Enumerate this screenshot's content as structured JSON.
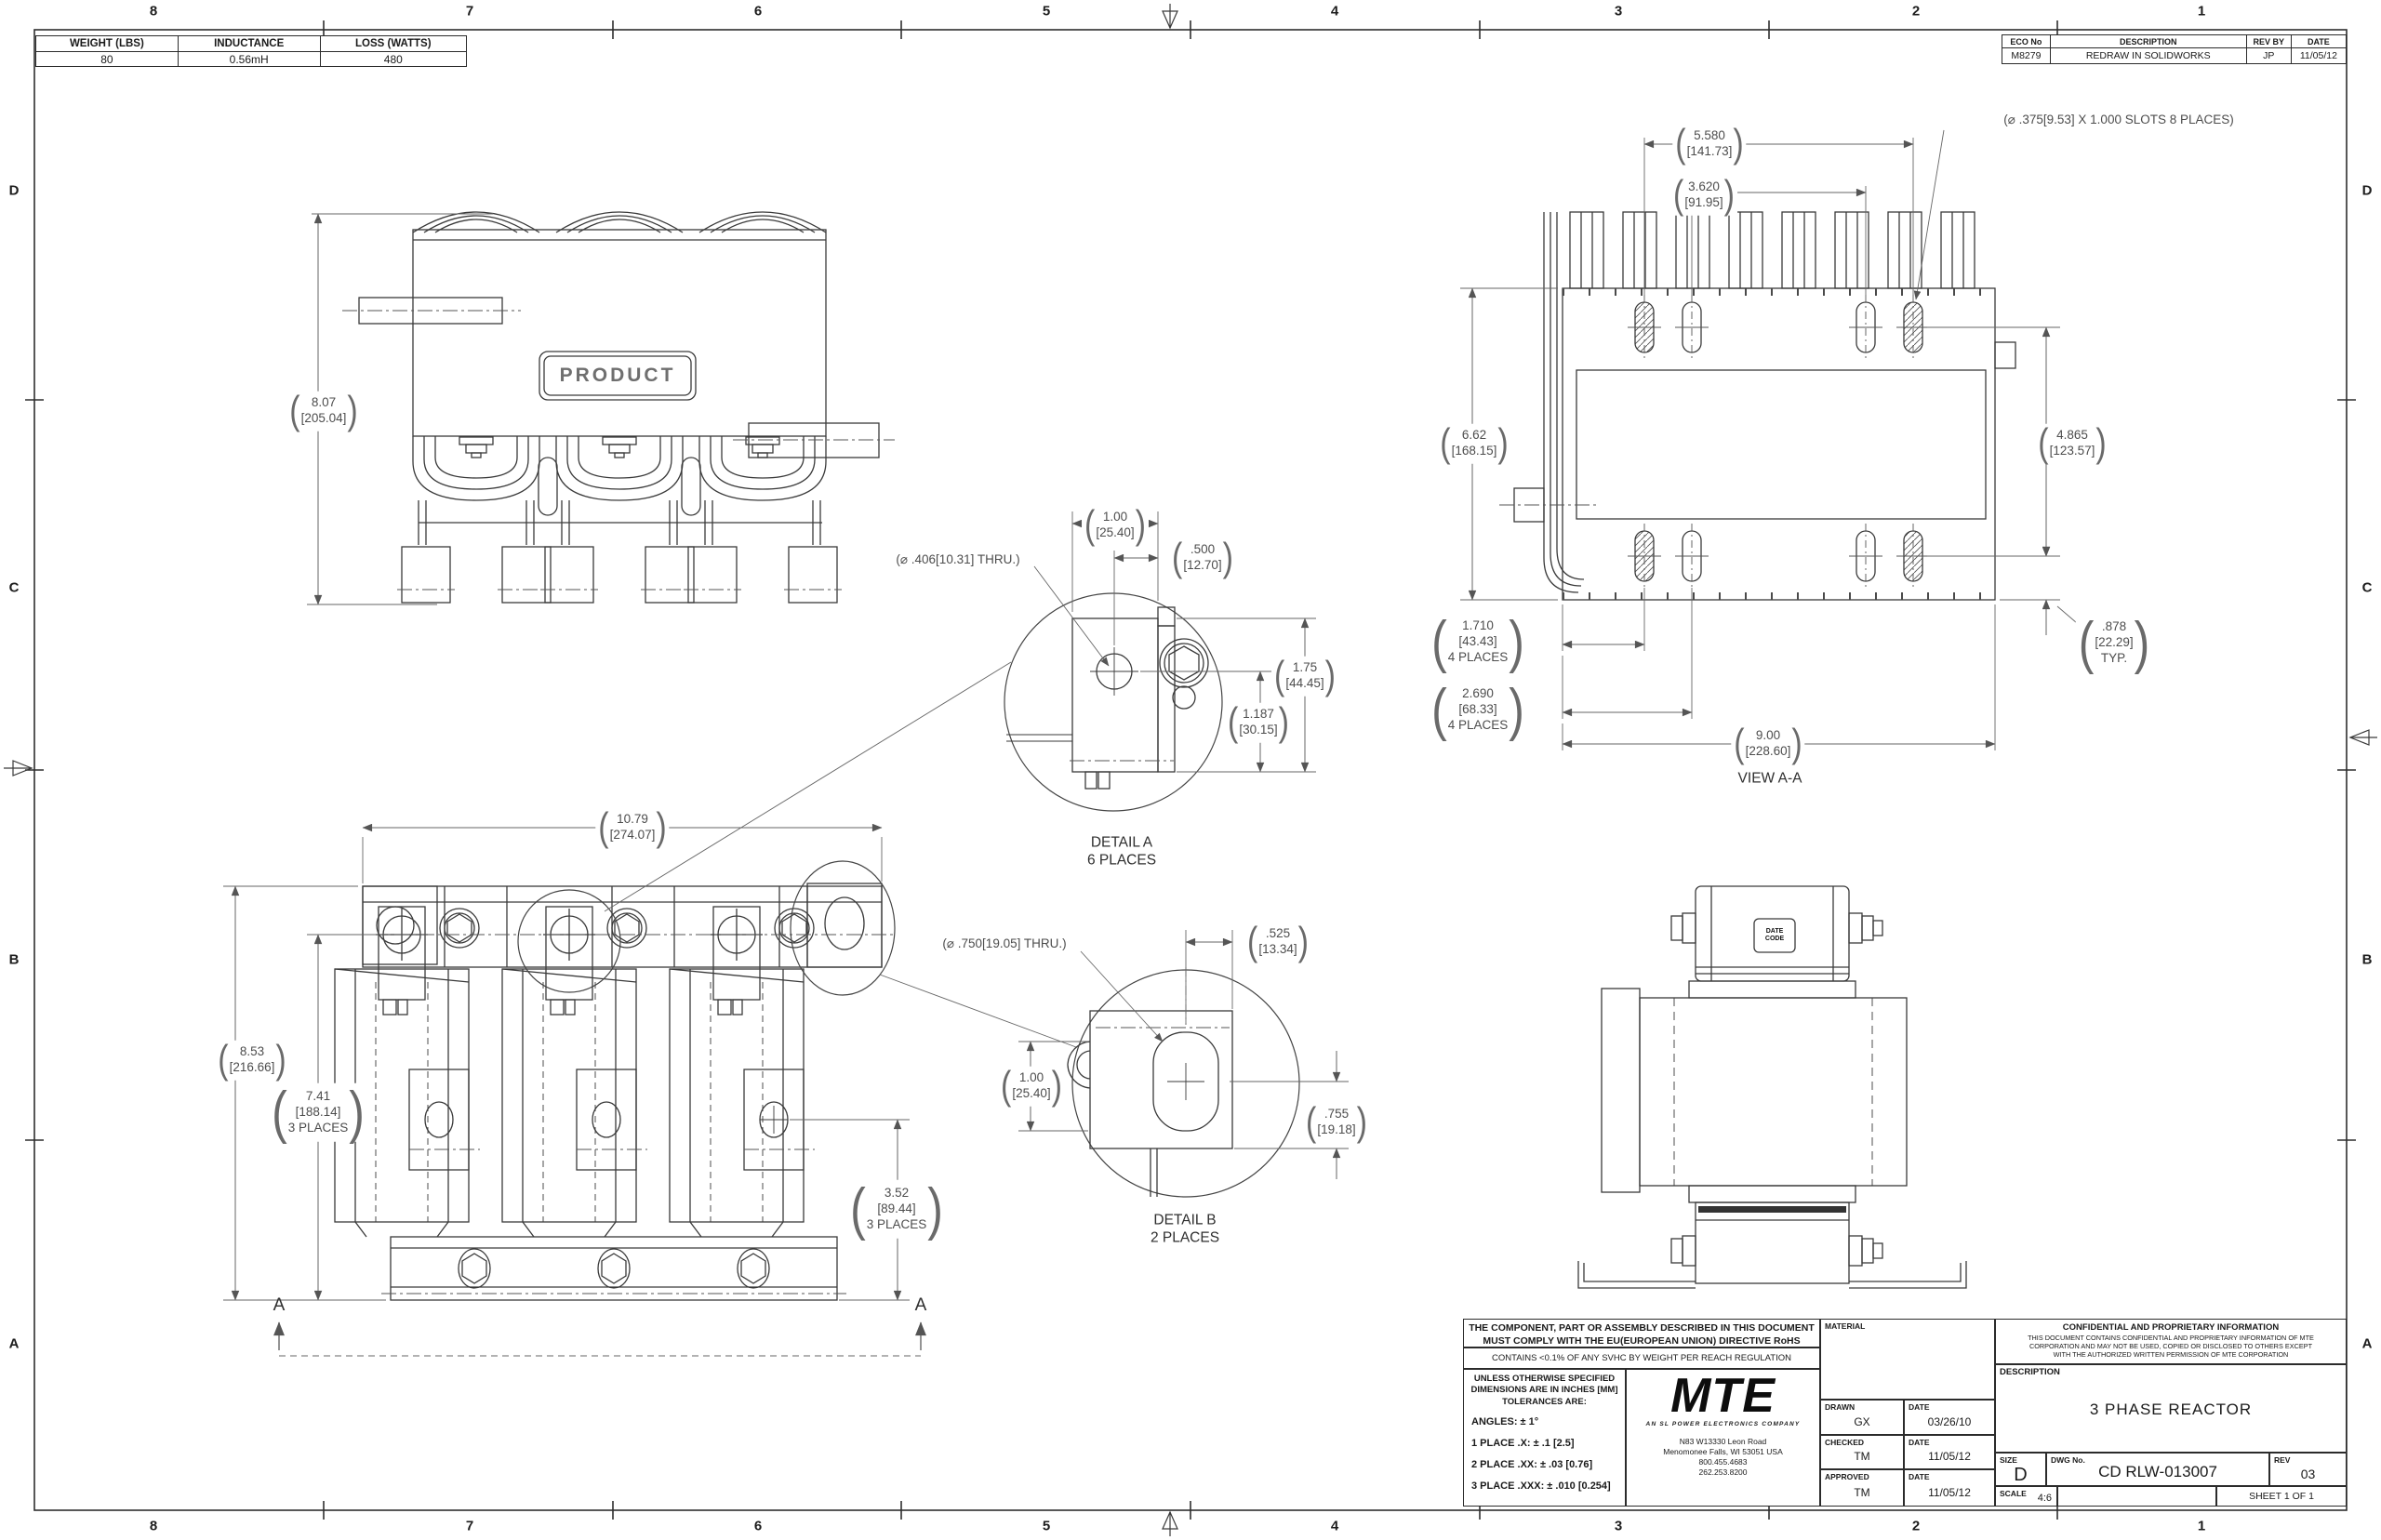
{
  "colors": {
    "part_line": "#3a3a3a",
    "dim_line": "#666666",
    "text": "#1a1a1a"
  },
  "sym": {
    "lp": "(",
    "rp": ")"
  },
  "zones": {
    "cols": [
      "8",
      "7",
      "6",
      "5",
      "4",
      "3",
      "2",
      "1"
    ],
    "rows": [
      "D",
      "C",
      "B",
      "A"
    ]
  },
  "spec_table": {
    "headers": [
      "WEIGHT (LBS)",
      "INDUCTANCE",
      "LOSS (WATTS)"
    ],
    "values": [
      "80",
      "0.56mH",
      "480"
    ]
  },
  "eco_table": {
    "headers": [
      "ECO No",
      "DESCRIPTION",
      "REV BY",
      "DATE"
    ],
    "values": [
      "M8279",
      "REDRAW IN SOLIDWORKS",
      "JP",
      "11/05/12"
    ]
  },
  "front_top": {
    "product": "PRODUCT",
    "dim_height": "8.07\n[205.04]"
  },
  "view_aa": {
    "label": "VIEW A-A",
    "dim_w1": "5.580\n[141.73]",
    "dim_w2": "3.620\n[91.95]",
    "note_slots": "(⌀ .375[9.53] X 1.000 SLOTS 8 PLACES)",
    "dim_h": "6.62\n[168.15]",
    "dim_right": "4.865\n[123.57]",
    "dim_typ": ".878\n[22.29]\nTYP.",
    "dim_d1": "1.710\n[43.43]\n4 PLACES",
    "dim_d2": "2.690\n[68.33]\n4 PLACES",
    "dim_w": "9.00\n[228.60]"
  },
  "detail_a": {
    "title": "DETAIL A\n6 PLACES",
    "note_hole": "(⌀ .406[10.31] THRU.)",
    "dim_1": "1.00\n[25.40]",
    "dim_2": ".500\n[12.70]",
    "dim_3": "1.75\n[44.45]",
    "dim_4": "1.187\n[30.15]"
  },
  "detail_b": {
    "title": "DETAIL B\n2 PLACES",
    "note_hole": "(⌀ .750[19.05] THRU.)",
    "dim_1": ".525\n[13.34]",
    "dim_2": "1.00\n[25.40]",
    "dim_3": ".755\n[19.18]"
  },
  "front_bottom": {
    "dim_w": "10.79\n[274.07]",
    "dim_h1": "8.53\n[216.66]",
    "dim_h2": "7.41\n[188.14]\n3 PLACES",
    "dim_h3": "3.52\n[89.44]\n3 PLACES",
    "section_letter": "A"
  },
  "side_view": {
    "date_code": "DATE\nCODE"
  },
  "title_block": {
    "rohs": "THE COMPONENT, PART OR ASSEMBLY DESCRIBED IN THIS DOCUMENT\nMUST COMPLY WITH THE EU(EUROPEAN UNION) DIRECTIVE RoHS",
    "reach": "CONTAINS <0.1% OF ANY SVHC BY WEIGHT PER REACH REGULATION",
    "tol_header": "UNLESS OTHERWISE SPECIFIED\nDIMENSIONS ARE IN INCHES [MM]\nTOLERANCES ARE:",
    "tol_angles": "ANGLES: ± 1°",
    "tol_1": "1 PLACE .X: ± .1 [2.5]",
    "tol_2": "2 PLACE .XX: ± .03 [0.76]",
    "tol_3": "3 PLACE .XXX: ± .010 [0.254]",
    "logo_text": "MTE",
    "logo_tagline": "AN SL POWER ELECTRONICS COMPANY",
    "address": "N83 W13330 Leon Road\nMenomonee Falls, WI 53051 USA\n800.455.4683\n262.253.8200",
    "material_label": "MATERIAL",
    "drawn_label": "DRAWN",
    "drawn_value": "GX",
    "date_label": "DATE",
    "drawn_date": "03/26/10",
    "checked_label": "CHECKED",
    "checked_value": "TM",
    "checked_date": "11/05/12",
    "approved_label": "APPROVED",
    "approved_value": "TM",
    "approved_date": "11/05/12",
    "conf_title": "CONFIDENTIAL AND PROPRIETARY INFORMATION",
    "conf_body": "THIS DOCUMENT CONTAINS CONFIDENTIAL AND PROPRIETARY INFORMATION OF MTE CORPORATION AND MAY NOT BE USED, COPIED OR DISCLOSED TO OTHERS EXCEPT WITH THE AUTHORIZED WRITTEN PERMISSION OF MTE CORPORATION",
    "desc_label": "DESCRIPTION",
    "desc_value": "3 PHASE REACTOR",
    "size_label": "SIZE",
    "size_value": "D",
    "dwg_label": "DWG No.",
    "dwg_value": "CD RLW-013007",
    "rev_label": "REV",
    "rev_value": "03",
    "scale_label": "SCALE",
    "scale_value": "4:6",
    "sheet_label": "SHEET 1 OF 1"
  }
}
